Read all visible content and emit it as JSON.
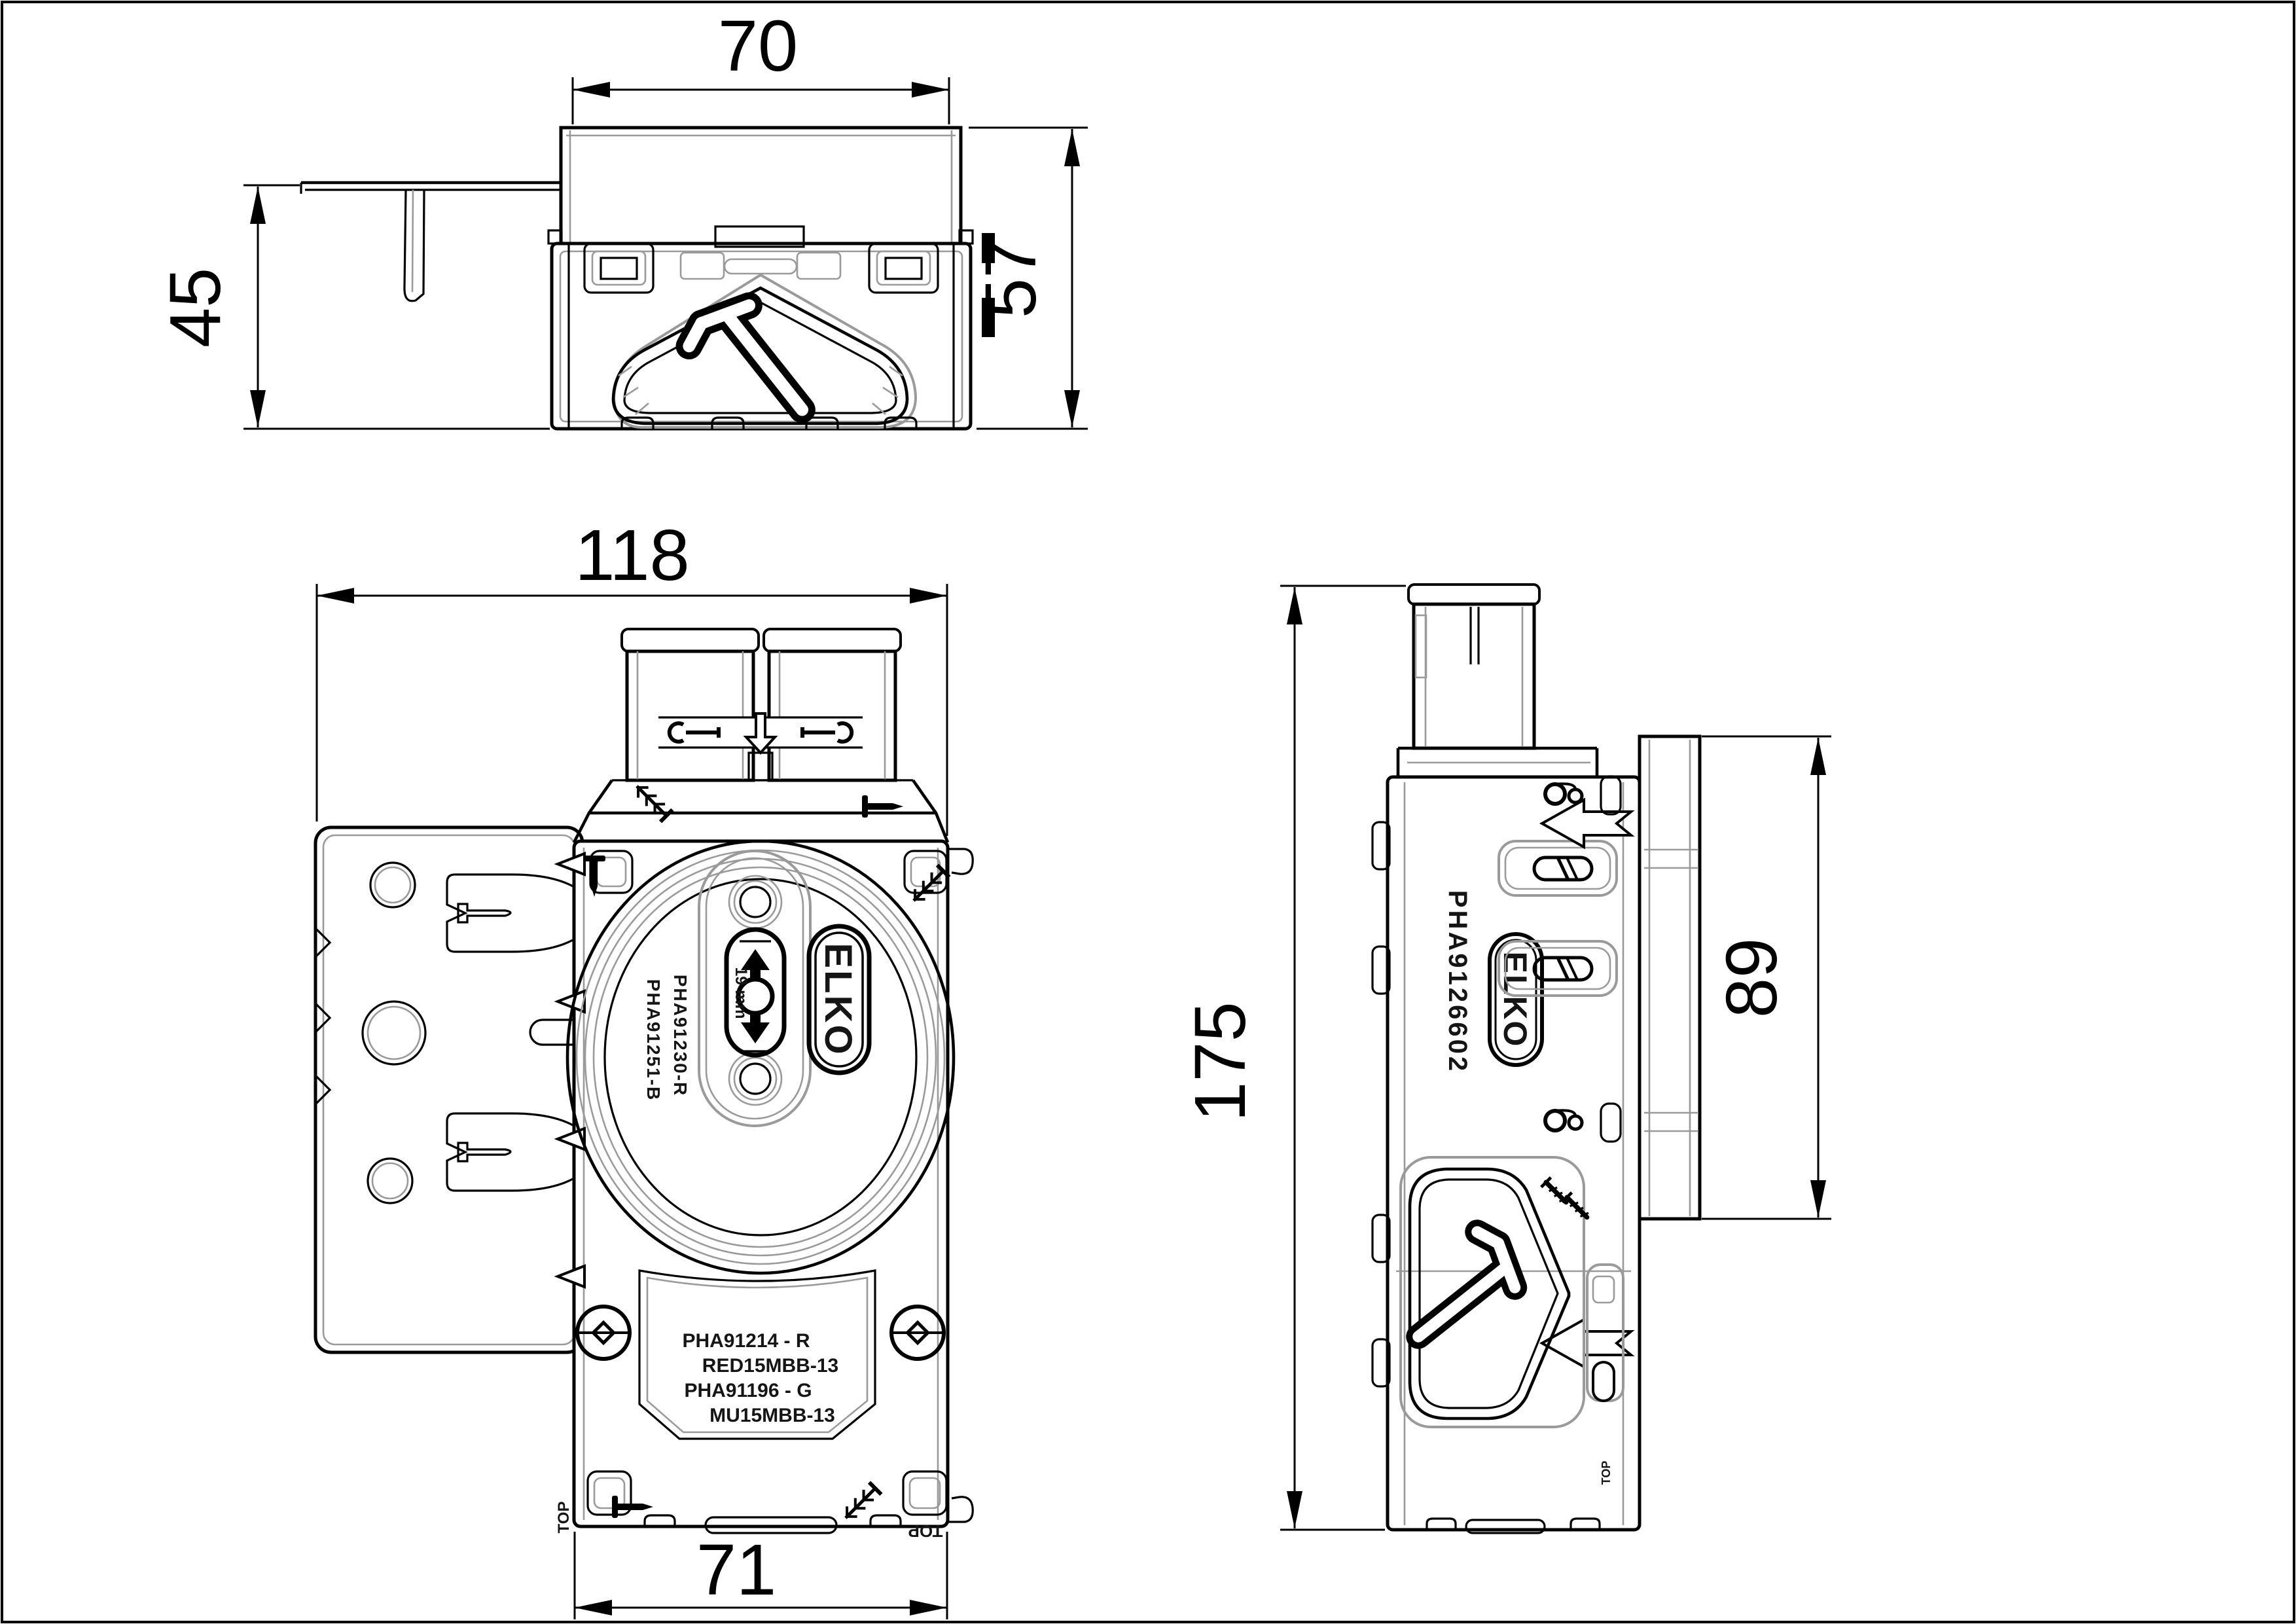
{
  "dimensions": {
    "top_width": "70",
    "top_height": "57",
    "bracket_height": "45",
    "front_total_width": "118",
    "front_body_width": "71",
    "side_height": "175",
    "side_depth": "89"
  },
  "front_view": {
    "logo": "ELKO",
    "gauge": "19 mm",
    "part_no_right": "PHA91230-R",
    "part_no_left": "PHA91251-B",
    "label_plate_lines": [
      "PHA91214 - R",
      "RED15MBB-13",
      "PHA91196 - G",
      "MU15MBB-13"
    ],
    "top_marker_left": "TOP",
    "top_marker_right": "TOP"
  },
  "side_view": {
    "logo": "ELKO",
    "part_no": "PHA9126602",
    "top_marker": "TOP"
  }
}
